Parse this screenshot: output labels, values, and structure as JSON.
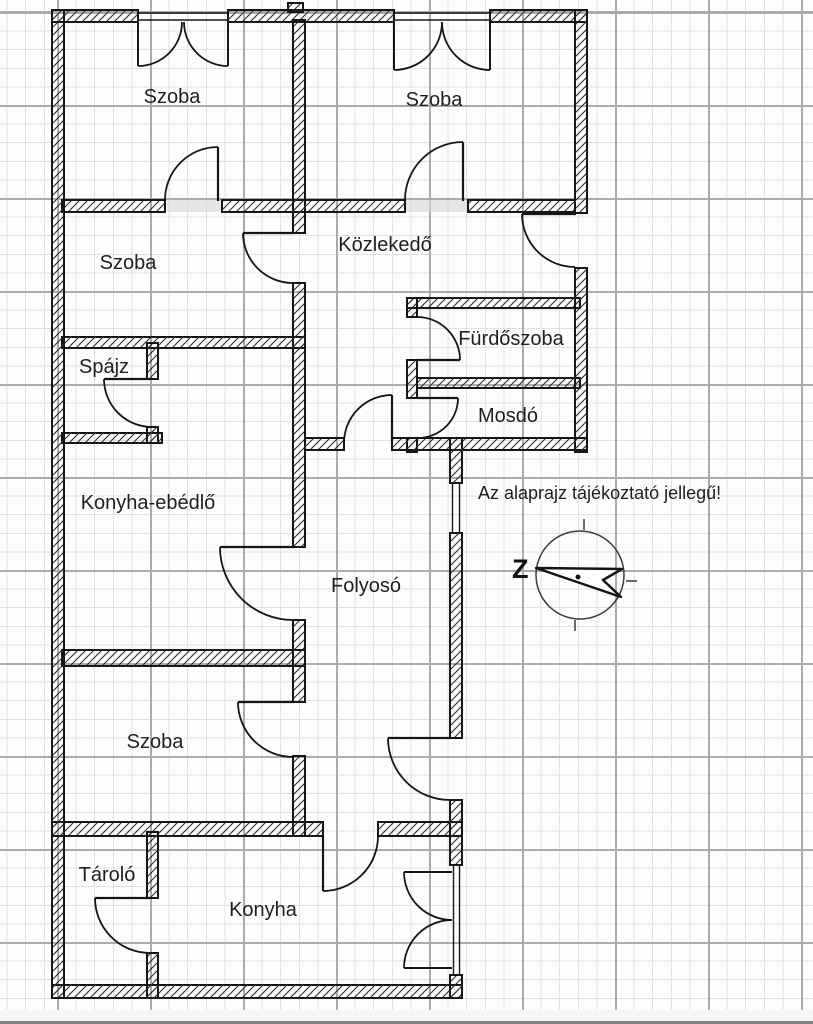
{
  "plan": {
    "rooms": {
      "szoba_top_left": "Szoba",
      "szoba_top_right": "Szoba",
      "kozlekedo": "Közlekedő",
      "szoba_middle": "Szoba",
      "spajz": "Spájz",
      "furdoszoba": "Fürdőszoba",
      "mosdo": "Mosdó",
      "konyha_ebedlo": "Konyha-ebédlő",
      "folyoso": "Folyosó",
      "szoba_bottom": "Szoba",
      "tarolo": "Tároló",
      "konyha": "Konyha"
    },
    "note": "Az alaprajz tájékoztató jellegű!",
    "compass": {
      "letter": "Z"
    },
    "colors": {
      "wall_line": "#161616",
      "grid_minor": "#e1e1e1",
      "grid_major": "#ababab",
      "label_text": "#1f1f1f"
    }
  }
}
